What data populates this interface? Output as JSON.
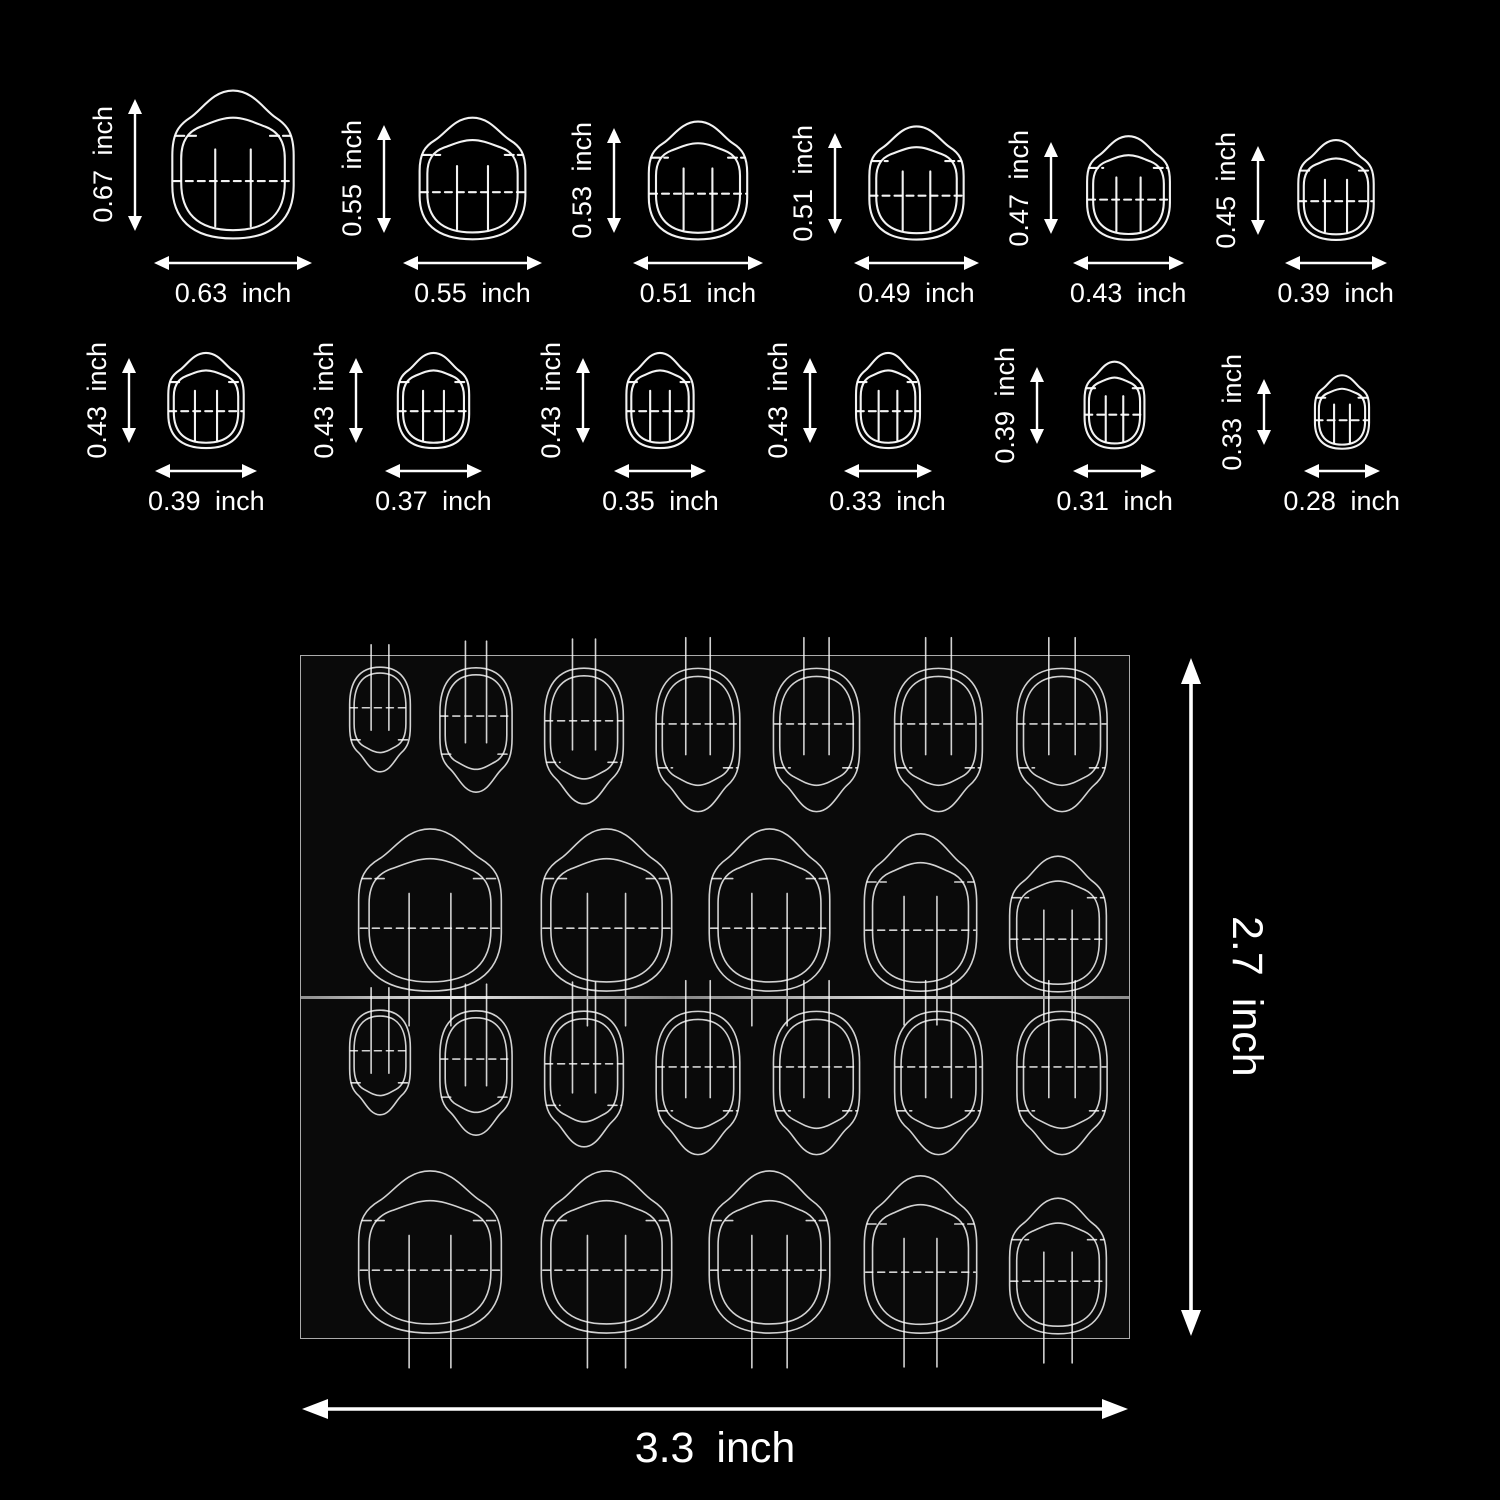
{
  "page": {
    "background": "#000000",
    "ink": "#ffffff"
  },
  "unit": "inch",
  "size_chart": {
    "rows": [
      {
        "nails": [
          {
            "h": 0.67,
            "w": 0.63,
            "height_label": "0.67 inch",
            "width_label": "0.63 inch"
          },
          {
            "h": 0.55,
            "w": 0.55,
            "height_label": "0.55 inch",
            "width_label": "0.55 inch"
          },
          {
            "h": 0.53,
            "w": 0.51,
            "height_label": "0.53 inch",
            "width_label": "0.51 inch"
          },
          {
            "h": 0.51,
            "w": 0.49,
            "height_label": "0.51 inch",
            "width_label": "0.49 inch"
          },
          {
            "h": 0.47,
            "w": 0.43,
            "height_label": "0.47 inch",
            "width_label": "0.43 inch"
          },
          {
            "h": 0.45,
            "w": 0.39,
            "height_label": "0.45 inch",
            "width_label": "0.39 inch"
          }
        ]
      },
      {
        "nails": [
          {
            "h": 0.43,
            "w": 0.39,
            "height_label": "0.43 inch",
            "width_label": "0.39 inch"
          },
          {
            "h": 0.43,
            "w": 0.37,
            "height_label": "0.43 inch",
            "width_label": "0.37 inch"
          },
          {
            "h": 0.43,
            "w": 0.35,
            "height_label": "0.43 inch",
            "width_label": "0.35 inch"
          },
          {
            "h": 0.43,
            "w": 0.33,
            "height_label": "0.43 inch",
            "width_label": "0.33 inch"
          },
          {
            "h": 0.39,
            "w": 0.31,
            "height_label": "0.39 inch",
            "width_label": "0.31 inch"
          },
          {
            "h": 0.33,
            "w": 0.28,
            "height_label": "0.33 inch",
            "width_label": "0.28 inch"
          }
        ]
      }
    ]
  },
  "sheet": {
    "width_label": "3.3 inch",
    "height_label": "2.7 inch",
    "halves": 2,
    "small_tabs_per_half": 7,
    "large_tabs_per_half": 5,
    "total_tabs": 24
  }
}
